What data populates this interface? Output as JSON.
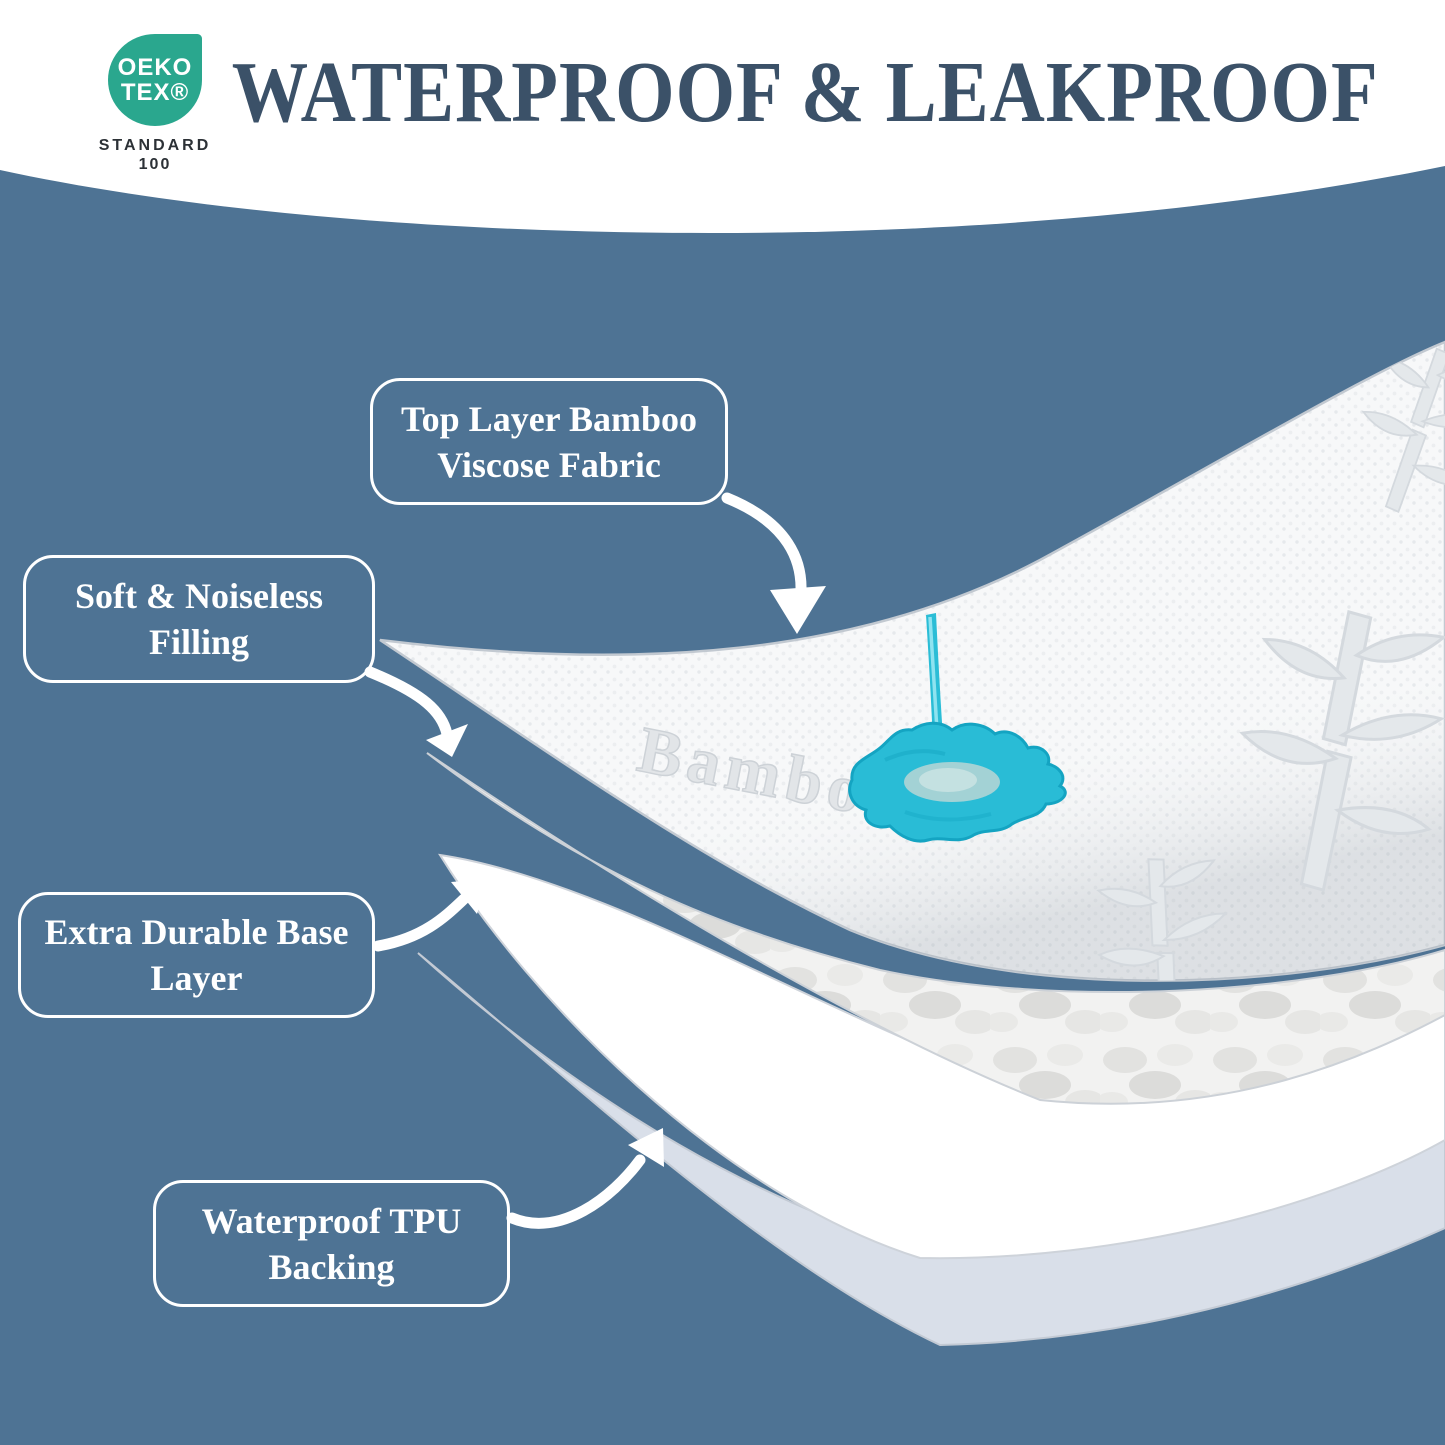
{
  "badge": {
    "brand_top": "OEKO",
    "brand_bottom": "TEX®",
    "standard_label": "STANDARD",
    "standard_number": "100"
  },
  "header": {
    "title": "WATERPROOF & LEAKPROOF"
  },
  "callouts": [
    {
      "line1": "Top Layer Bamboo",
      "line2": "Viscose Fabric"
    },
    {
      "line1": "Soft & Noiseless",
      "line2": "Filling"
    },
    {
      "line1": "Extra Durable Base",
      "line2": "Layer"
    },
    {
      "line1": "Waterproof TPU",
      "line2": "Backing"
    }
  ],
  "illustration": {
    "embossed_text": "Bamboo",
    "colors": {
      "background": "#4e7394",
      "title_text": "#3b5168",
      "badge_teal": "#2aa78e",
      "splash_cyan": "#29bcd6",
      "tpu_layer": "#d9dfe9",
      "fabric": "#f7f8f9"
    }
  }
}
